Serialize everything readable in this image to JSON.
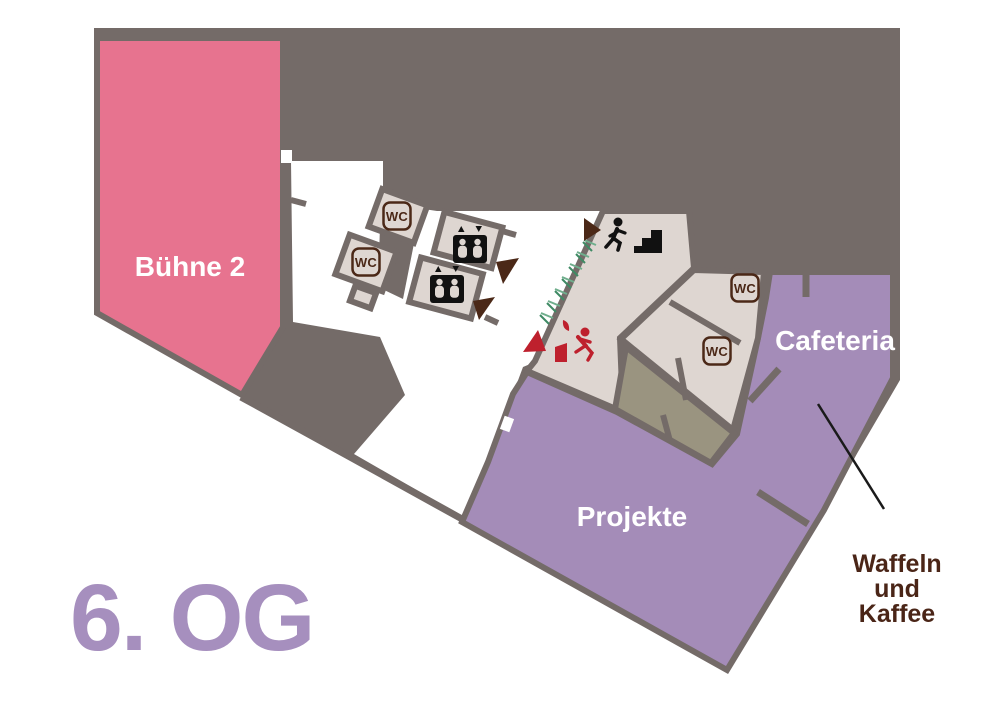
{
  "floor_label": "6. OG",
  "rooms": {
    "stage": {
      "label": "Bühne 2"
    },
    "projects": {
      "label": "Projekte"
    },
    "cafeteria": {
      "label": "Cafeteria"
    }
  },
  "annotation": {
    "line1": "Waffeln",
    "line2": "und",
    "line3": "Kaffee"
  },
  "signs": {
    "wc": "WC"
  },
  "icons": {
    "wc": "wc-sign-icon",
    "elevator": "elevator-icon",
    "stairs": "stairs-icon",
    "emergency_exit": "emergency-exit-icon",
    "direction_marker": "direction-triangle-icon"
  },
  "colors": {
    "background": "#FFFFFF",
    "mass_gray": "#746B68",
    "stage_pink": "#E7738F",
    "room_purple": "#A48CB8",
    "floor_label_purple": "#A68FBE",
    "room_beige": "#DED6D1",
    "room_olive": "#9A9480",
    "exit_red": "#BE202D",
    "arrow_brown": "#4B2817",
    "sign_brown": "#4B2817",
    "text_brown": "#4A2517",
    "hatch_green": "#6FAE8C",
    "hatch_green_dark": "#3F8A64",
    "annotation_line": "#1A1A1A",
    "icon_black": "#111111",
    "label_white": "#FFFFFF"
  }
}
